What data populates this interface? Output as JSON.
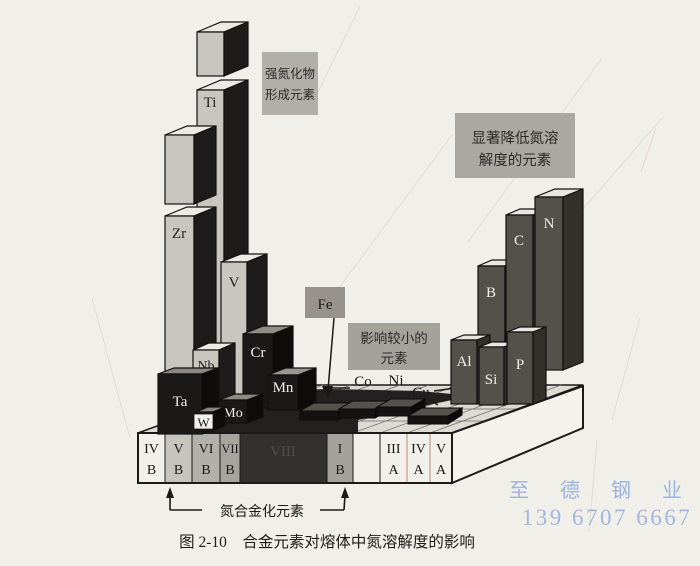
{
  "caption": "图 2-10　合金元素对熔体中氮溶解度的影响",
  "annotations": {
    "strong_nitride_box": {
      "line1": "强氮化物",
      "line2": "形成元素"
    },
    "reduce_box": {
      "line1": "显著降低氮溶",
      "line2": "解度的元素"
    },
    "minor_box": {
      "line1": "影响较小的",
      "line2": "元素"
    },
    "fe_label": "Fe",
    "bracket_label": "氮合金化元素"
  },
  "element_labels": {
    "ti": "Ti",
    "zr": "Zr",
    "v": "V",
    "nb": "Nb",
    "ta": "Ta",
    "w": "W",
    "mo": "Mo",
    "cr": "Cr",
    "mn": "Mn",
    "co": "Co",
    "ni": "Ni",
    "cu": "Cu",
    "al": "Al",
    "si": "Si",
    "p": "P",
    "b": "B",
    "c": "C",
    "n": "N"
  },
  "base": {
    "groups": [
      {
        "numeral": "IV",
        "letter": "B"
      },
      {
        "numeral": "V",
        "letter": "B"
      },
      {
        "numeral": "VI",
        "letter": "B"
      },
      {
        "numeral": "VII",
        "letter": "B"
      },
      {
        "numeral": "VIII",
        "letter": ""
      },
      {
        "numeral": "I",
        "letter": "B"
      },
      {
        "numeral": "",
        "letter": ""
      },
      {
        "numeral": "III",
        "letter": "A"
      },
      {
        "numeral": "IV",
        "letter": "A"
      },
      {
        "numeral": "V",
        "letter": "A"
      }
    ]
  },
  "watermark": {
    "name": "至 德 钢 业",
    "phone": "139 6707 6667"
  },
  "diagram_data": {
    "type": "3d-periodic-bar-diagram",
    "categories": {
      "strong_nitride_formers": [
        "Ti",
        "Zr",
        "V",
        "Nb",
        "Ta",
        "W",
        "Mo",
        "Cr",
        "Mn"
      ],
      "minor_influence": [
        "Fe",
        "Co",
        "Ni",
        "Cu"
      ],
      "strong_solubility_reducers": [
        "Al",
        "Si",
        "P",
        "B",
        "C",
        "N"
      ]
    },
    "bracket_span_groups": [
      "V B",
      "I B"
    ],
    "bars_relative_height_px": {
      "Ti": 390,
      "Zr": 300,
      "V": 150,
      "Nb": 73,
      "Ta": 62,
      "W": 20,
      "Mo": 24,
      "Cr": 76,
      "Mn": 37,
      "Fe": 9,
      "Co": 9,
      "Ni": 9,
      "Cu": 8,
      "Al": 65,
      "Si": 59,
      "P": 74,
      "B": 86,
      "C": 145,
      "N": 175
    },
    "truncated_bars": [
      "Ti",
      "Zr"
    ]
  },
  "colors": {
    "paper": "#f1efe9",
    "light_bar_front": "#c9c6c0",
    "dark_bar_front": "#1a1918",
    "right_bar_front": "#54504a",
    "label_box_bg": "#aba8a2",
    "watermark_blue": "#8ea8de"
  }
}
